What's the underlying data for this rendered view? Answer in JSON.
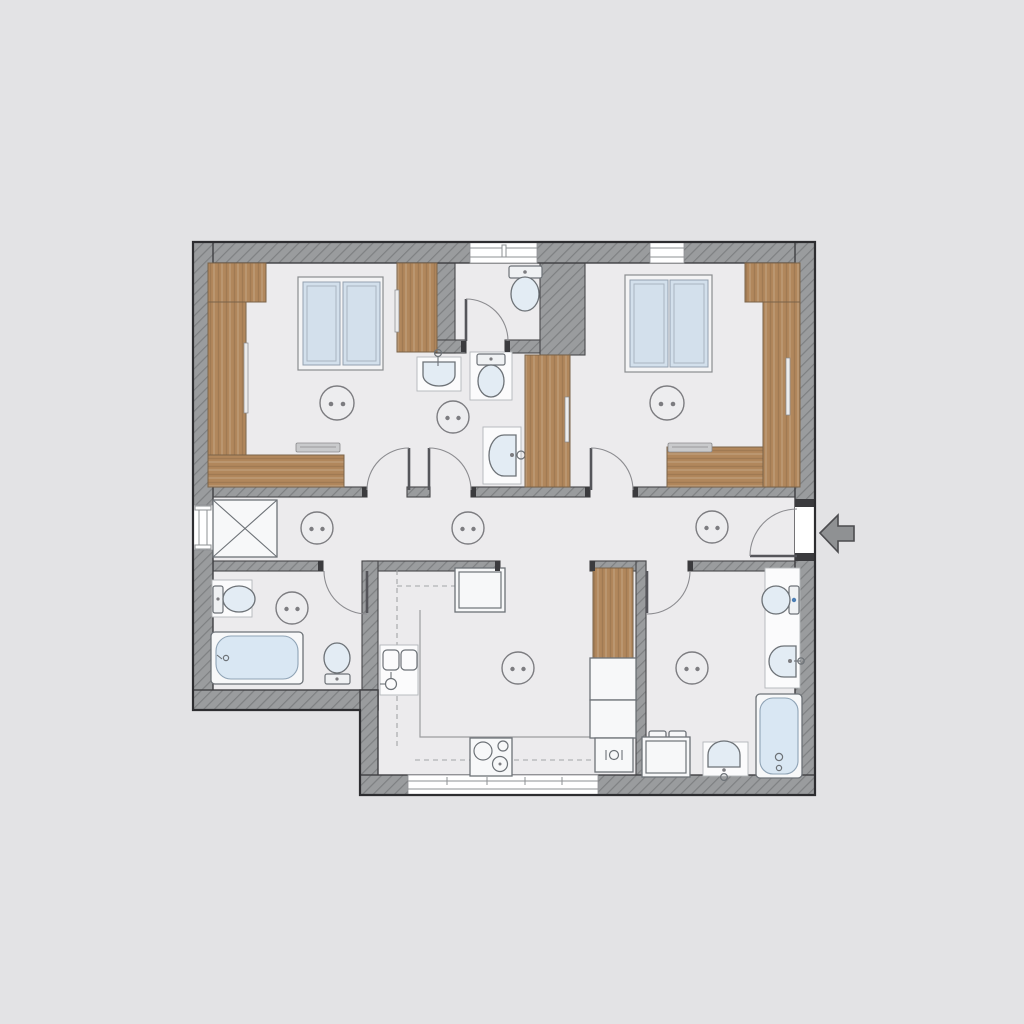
{
  "title": "apartment-floor-plan",
  "palette": {
    "background": "#e3e3e5",
    "floor": "#ecebed",
    "wall_fill": "#9a9c9e",
    "wall_hatch": "#7e8082",
    "wall_outline": "#404043",
    "wood": "#b1875c",
    "wood_edge": "#7a6349",
    "glass": "#d3e0ec",
    "window_frame": "#f4f4f5",
    "tub_fill": "#d9e7f3",
    "fixture_fill": "#f7f8f9",
    "fixture_line": "#6d7277",
    "door_line": "#8c8c90",
    "dash_line": "#a2a4a6",
    "arrow_fill": "#8f9193"
  },
  "entrance": {
    "location": "right-exterior-wall",
    "arrow_direction": "left-into-apartment"
  },
  "rooms": [
    {
      "id": "bedroom-left",
      "fixtures": [
        "wardrobe-l-shape",
        "wardrobe-right-block",
        "double-window-unit",
        "desk-with-laptop",
        "ceiling-light",
        "door-to-hallway"
      ]
    },
    {
      "id": "wc-top-center",
      "fixtures": [
        "toilet",
        "wall-window",
        "door"
      ]
    },
    {
      "id": "shower-room-center",
      "fixtures": [
        "washbasin",
        "toilet",
        "vanity-basin-alcove",
        "ceiling-light",
        "door-to-hallway"
      ]
    },
    {
      "id": "bedroom-right",
      "fixtures": [
        "wardrobe-column",
        "wardrobe-top-block",
        "tall-wardrobe-mid",
        "double-window-unit",
        "desk-with-laptop",
        "ceiling-light",
        "door-to-hallway"
      ]
    },
    {
      "id": "hallway",
      "fixtures": [
        "x-closet",
        "ceiling-light",
        "ceiling-light",
        "ceiling-light",
        "entrance-door",
        "wall-window-left"
      ]
    },
    {
      "id": "bathroom-left",
      "fixtures": [
        "toilet",
        "bathtub",
        "bidet",
        "ceiling-light",
        "door"
      ]
    },
    {
      "id": "kitchen",
      "fixtures": [
        "fridge",
        "counter-dashed-outline",
        "double-sink",
        "cooktop",
        "tall-cabinet",
        "base-cabinets",
        "oven-appliance",
        "ceiling-light",
        "bottom-window"
      ]
    },
    {
      "id": "bathroom-right",
      "fixtures": [
        "toilet",
        "washbasin",
        "bathtub",
        "washing-machine",
        "basin-unit",
        "vanity-counter",
        "ceiling-light",
        "door"
      ]
    }
  ],
  "ceiling_lights_total": 9
}
